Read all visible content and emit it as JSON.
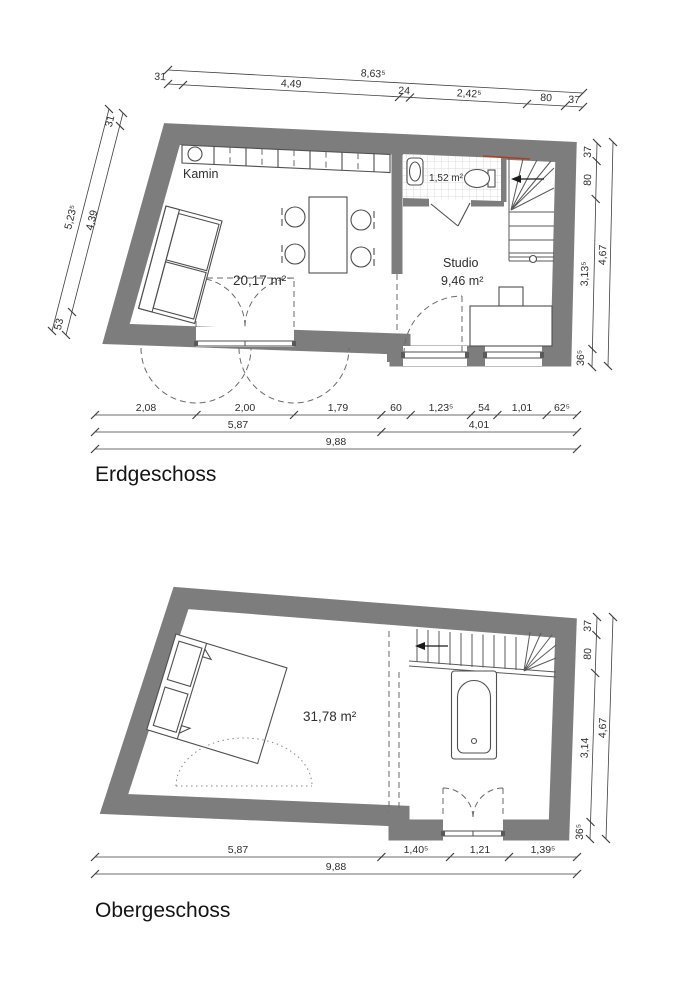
{
  "colors": {
    "wall": "#7d7d7d",
    "line": "#3f3f3f",
    "red_marker": "#b23b26"
  },
  "eg": {
    "title": "Erdgeschoss",
    "rooms": {
      "kamin_label": "Kamin",
      "living_area": "20,17 m²",
      "studio_name": "Studio",
      "studio_area": "9,46 m²",
      "bath_area": "1,52 m²"
    },
    "dims": {
      "top": {
        "seg31": "31",
        "total": "8,63⁵",
        "seg449": "4,49",
        "seg24": "24",
        "seg2425": "2,42⁵",
        "seg80": "80",
        "seg37": "37"
      },
      "left": {
        "seg31": "31",
        "total": "5,23⁵",
        "seg439": "4,39",
        "seg53": "53"
      },
      "right": {
        "seg37": "37",
        "seg80": "80",
        "seg3135": "3,13⁵",
        "total": "4,67",
        "seg365": "36⁵"
      },
      "bottom1": [
        "2,08",
        "2,00",
        "1,79",
        "60",
        "1,23⁵",
        "54",
        "1,01",
        "62⁵"
      ],
      "bottom2": [
        "5,87",
        "4,01"
      ],
      "bottom3": [
        "9,88"
      ]
    }
  },
  "og": {
    "title": "Obergeschoss",
    "rooms": {
      "area": "31,78 m²"
    },
    "dims": {
      "right": {
        "seg37": "37",
        "seg80": "80",
        "seg314": "3,14",
        "total": "4,67",
        "seg365": "36⁵"
      },
      "bottom1": [
        "5,87",
        "1,40⁵",
        "1,21",
        "1,39⁵"
      ],
      "bottom2": [
        "9,88"
      ]
    }
  }
}
